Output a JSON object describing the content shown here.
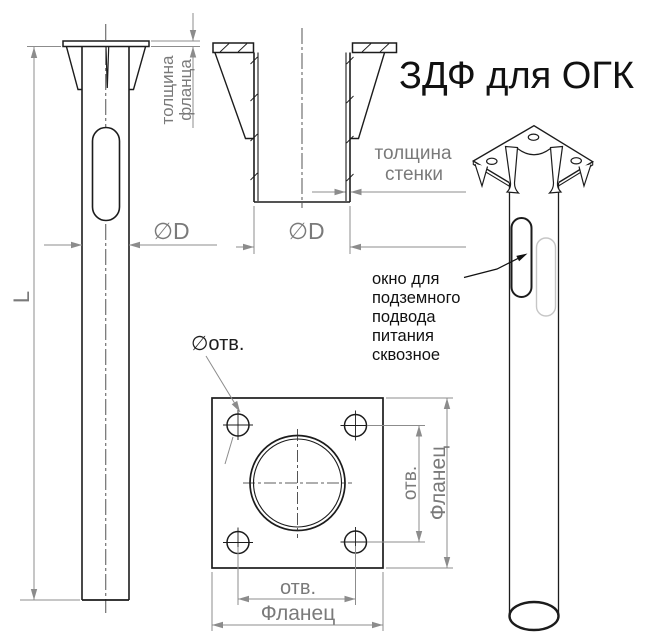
{
  "title": "ЗДФ для ОГК",
  "front_view": {
    "length_label": "L",
    "diameter_label": "∅D",
    "flange_thickness_label": [
      "толщина",
      "фланца"
    ]
  },
  "section_view": {
    "diameter_label": "∅D",
    "wall_thickness_label": [
      "толщина",
      "стенки"
    ]
  },
  "plan_view": {
    "hole_diameter_label": "∅отв.",
    "hole_spacing_label_h": "отв.",
    "flange_width_label": "Фланец",
    "hole_spacing_label_v": "отв.",
    "flange_height_label": "Фланец"
  },
  "iso_view": {
    "window_note_lines": [
      "окно для",
      "подземного",
      "подвода",
      "питания",
      "сквозное"
    ]
  },
  "colors": {
    "outline": "#1c1c1c",
    "dimension": "#8c8c8c",
    "dim_text": "#7a7a7a",
    "note_text": "#111111",
    "ghost": "#c6c6c6",
    "background": "#ffffff"
  }
}
